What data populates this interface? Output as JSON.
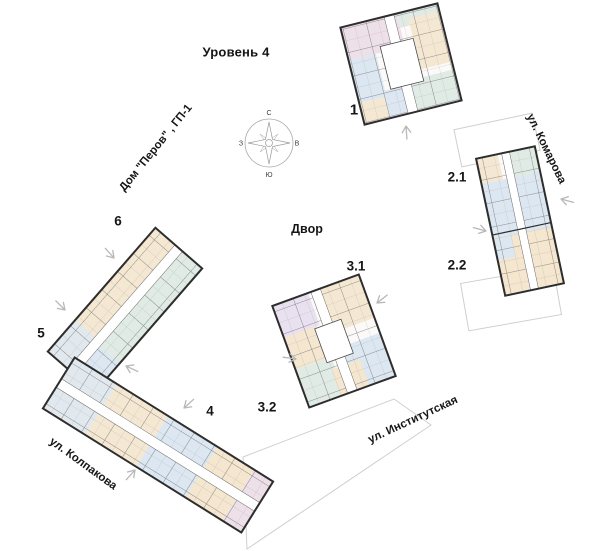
{
  "title": "Уровень 4",
  "project_label": "Дом \"Перов\" , ГП-1",
  "courtyard_label": "Двор",
  "streets": {
    "komarova": "ул. Комарова",
    "institutskaya": "ул. Институтская",
    "kolpakova": "ул. Колпакова"
  },
  "compass": {
    "north": "С",
    "south": "Ю",
    "west": "З",
    "east": "В"
  },
  "buildings": {
    "b1": {
      "label": "1"
    },
    "b2_1": {
      "label": "2.1"
    },
    "b2_2": {
      "label": "2.2"
    },
    "b3_1": {
      "label": "3.1"
    },
    "b3_2": {
      "label": "3.2"
    },
    "b4": {
      "label": "4"
    },
    "b5": {
      "label": "5"
    },
    "b6": {
      "label": "6"
    }
  },
  "colors": {
    "wall": "#2d2d2d",
    "unit_pink": "#eee0e9",
    "unit_lavender": "#e9e1ef",
    "unit_blue": "#dce7f1",
    "unit_teal": "#e0ebe5",
    "unit_peach": "#f5e8d3",
    "unit_tan": "#f4e6cf",
    "site_outline_gray": "#cfcfcf",
    "arrow_gray": "#b8b8b8"
  }
}
